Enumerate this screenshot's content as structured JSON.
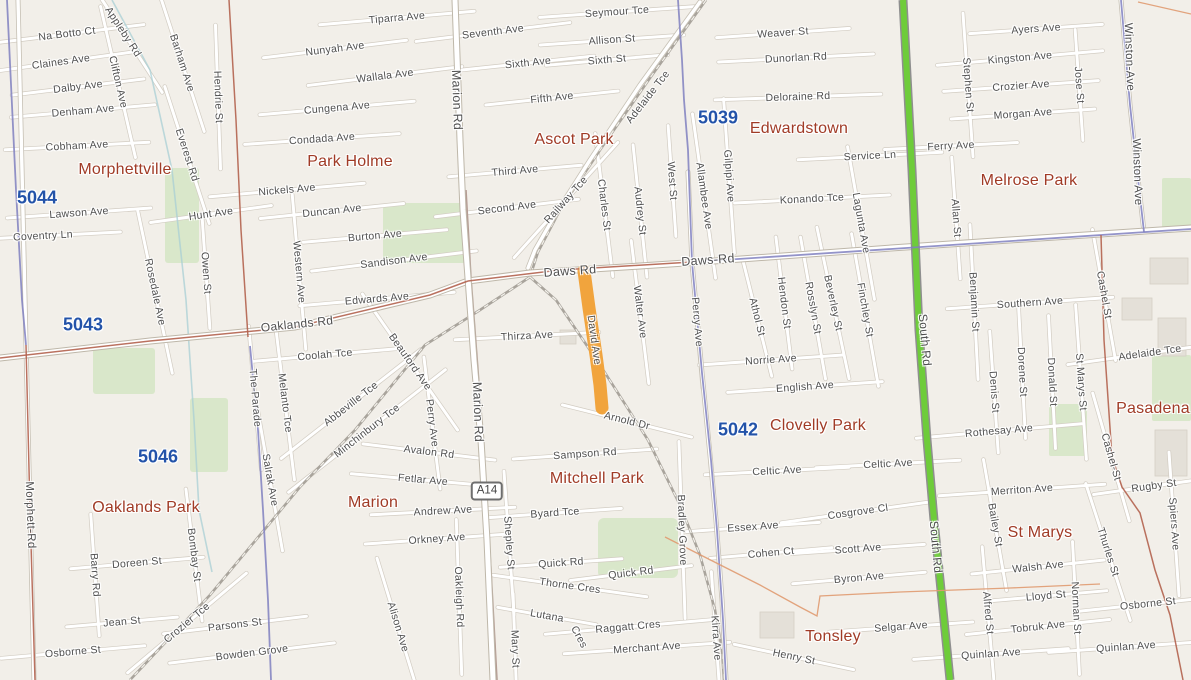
{
  "map": {
    "background": "#f2efe9",
    "colors": {
      "highlight": "#f1a43d",
      "route_green": "#6ecc3a",
      "admin_blue": "#8080bf",
      "admin_red": "#b3624e",
      "boundary_orange": "#e09a70",
      "park": "#d9e7ca",
      "building": "#e4e0d8",
      "street_text": "#4f4f4f",
      "suburb_text": "#a03b26",
      "postcode_text": "#2353a9",
      "road_fill": "#ffffff",
      "rail": "#a9a49c"
    },
    "highlighted_road": {
      "name": "David Ave",
      "color": "#f1a43d"
    },
    "route_badges": [
      {
        "t": "A14",
        "x": 487,
        "y": 491
      }
    ],
    "postcodes": [
      {
        "t": "5044",
        "x": 37,
        "y": 198
      },
      {
        "t": "5043",
        "x": 83,
        "y": 325
      },
      {
        "t": "5046",
        "x": 158,
        "y": 457
      },
      {
        "t": "5039",
        "x": 718,
        "y": 118
      },
      {
        "t": "5042",
        "x": 738,
        "y": 430
      }
    ],
    "suburbs": [
      {
        "t": "Morphettville",
        "x": 125,
        "y": 170
      },
      {
        "t": "Park Holme",
        "x": 350,
        "y": 162
      },
      {
        "t": "Ascot Park",
        "x": 574,
        "y": 140
      },
      {
        "t": "Edwardstown",
        "x": 799,
        "y": 129
      },
      {
        "t": "Melrose Park",
        "x": 1029,
        "y": 181
      },
      {
        "t": "Oaklands Park",
        "x": 146,
        "y": 508
      },
      {
        "t": "Marion",
        "x": 373,
        "y": 503
      },
      {
        "t": "Mitchell Park",
        "x": 597,
        "y": 479
      },
      {
        "t": "Clovelly Park",
        "x": 818,
        "y": 426
      },
      {
        "t": "St Marys",
        "x": 1040,
        "y": 533
      },
      {
        "t": "Tonsley",
        "x": 833,
        "y": 637
      },
      {
        "t": "Pasadena",
        "x": 1153,
        "y": 409
      }
    ],
    "streets": [
      {
        "t": "Appleby Rd",
        "x": 123,
        "y": 32,
        "r": 57
      },
      {
        "t": "Na Botto Ct",
        "x": 67,
        "y": 34,
        "r": -7
      },
      {
        "t": "Claines Ave",
        "x": 61,
        "y": 62,
        "r": -8
      },
      {
        "t": "Clifton Ave",
        "x": 118,
        "y": 82,
        "r": 77
      },
      {
        "t": "Barham Ave",
        "x": 182,
        "y": 63,
        "r": 72
      },
      {
        "t": "Dalby Ave",
        "x": 78,
        "y": 87,
        "r": -7
      },
      {
        "t": "Hendrie St",
        "x": 218,
        "y": 97,
        "r": 88
      },
      {
        "t": "Denham Ave",
        "x": 83,
        "y": 111,
        "r": -5
      },
      {
        "t": "Everest Rd",
        "x": 187,
        "y": 155,
        "r": 72
      },
      {
        "t": "Cobham Ave",
        "x": 77,
        "y": 146,
        "r": -3
      },
      {
        "t": "Hunt Ave",
        "x": 211,
        "y": 214,
        "r": -8
      },
      {
        "t": "Lawson Ave",
        "x": 79,
        "y": 213,
        "r": -4
      },
      {
        "t": "Coventry Ln",
        "x": 43,
        "y": 236,
        "r": -3
      },
      {
        "t": "Nickels Ave",
        "x": 287,
        "y": 190,
        "r": -5
      },
      {
        "t": "Duncan Ave",
        "x": 332,
        "y": 211,
        "r": -6
      },
      {
        "t": "Owen St",
        "x": 206,
        "y": 273,
        "r": 86
      },
      {
        "t": "Rosedale Ave",
        "x": 155,
        "y": 292,
        "r": 78
      },
      {
        "t": "Western Ave",
        "x": 299,
        "y": 272,
        "r": 85
      },
      {
        "t": "Burton Ave",
        "x": 375,
        "y": 236,
        "r": -5
      },
      {
        "t": "Sandison Ave",
        "x": 394,
        "y": 261,
        "r": -7
      },
      {
        "t": "Edwards Ave",
        "x": 377,
        "y": 299,
        "r": -5
      },
      {
        "t": "Oaklands Rd",
        "x": 297,
        "y": 324,
        "r": -6,
        "s": 12,
        "nr": true
      },
      {
        "t": "The-Parade",
        "x": 255,
        "y": 398,
        "r": 85
      },
      {
        "t": "Melanto Tce",
        "x": 285,
        "y": 403,
        "r": 83
      },
      {
        "t": "Salrak Ave",
        "x": 270,
        "y": 480,
        "r": 80
      },
      {
        "t": "Morphett-Rd",
        "x": 30,
        "y": 515,
        "r": 88,
        "s": 11.5,
        "nr": true
      },
      {
        "t": "Tiparra Ave",
        "x": 397,
        "y": 18,
        "r": -5
      },
      {
        "t": "Nunyah Ave",
        "x": 335,
        "y": 49,
        "r": -7
      },
      {
        "t": "Wallala Ave",
        "x": 385,
        "y": 76,
        "r": -7
      },
      {
        "t": "Cungena Ave",
        "x": 337,
        "y": 108,
        "r": -5
      },
      {
        "t": "Condada Ave",
        "x": 322,
        "y": 139,
        "r": -4
      },
      {
        "t": "Marion Rd",
        "x": 457,
        "y": 100,
        "r": 88,
        "s": 12.5,
        "nr": true
      },
      {
        "t": "Marion Rd",
        "x": 478,
        "y": 412,
        "r": 88,
        "s": 12.5,
        "nr": true
      },
      {
        "t": "Seventh Ave",
        "x": 493,
        "y": 32,
        "r": -7
      },
      {
        "t": "Sixth Ave",
        "x": 528,
        "y": 63,
        "r": -6
      },
      {
        "t": "Sixth St",
        "x": 607,
        "y": 60,
        "r": -5
      },
      {
        "t": "Fifth Ave",
        "x": 552,
        "y": 98,
        "r": -6
      },
      {
        "t": "Third Ave",
        "x": 515,
        "y": 171,
        "r": -5
      },
      {
        "t": "Second Ave",
        "x": 507,
        "y": 208,
        "r": -7
      },
      {
        "t": "Railway Tce",
        "x": 566,
        "y": 200,
        "r": -48
      },
      {
        "t": "Charles St",
        "x": 604,
        "y": 205,
        "r": 83
      },
      {
        "t": "Audrey St",
        "x": 640,
        "y": 211,
        "r": 84
      },
      {
        "t": "Seymour Tce",
        "x": 617,
        "y": 12,
        "r": -4
      },
      {
        "t": "Allison St",
        "x": 612,
        "y": 40,
        "r": -4
      },
      {
        "t": "Adelaide Tce",
        "x": 648,
        "y": 97,
        "r": -52,
        "nr": true
      },
      {
        "t": "West St",
        "x": 672,
        "y": 181,
        "r": 86
      },
      {
        "t": "Allambee Ave",
        "x": 704,
        "y": 196,
        "r": 82
      },
      {
        "t": "Gilpipi Ave",
        "x": 729,
        "y": 176,
        "r": 86
      },
      {
        "t": "Weaver St",
        "x": 783,
        "y": 33,
        "r": -4
      },
      {
        "t": "Dunorlan Rd",
        "x": 796,
        "y": 58,
        "r": -3
      },
      {
        "t": "Deloraine Rd",
        "x": 798,
        "y": 97,
        "r": -2
      },
      {
        "t": "Konando Tce",
        "x": 812,
        "y": 199,
        "r": -3
      },
      {
        "t": "Service Ln",
        "x": 870,
        "y": 156,
        "r": -3
      },
      {
        "t": "Ferry Ave",
        "x": 951,
        "y": 146,
        "r": -3
      },
      {
        "t": "Lagunta Ave",
        "x": 861,
        "y": 223,
        "r": 80
      },
      {
        "t": "Ayers Ave",
        "x": 1036,
        "y": 29,
        "r": -4
      },
      {
        "t": "Kingston Ave",
        "x": 1020,
        "y": 58,
        "r": -5
      },
      {
        "t": "Stephen St",
        "x": 968,
        "y": 85,
        "r": 86
      },
      {
        "t": "Crozier Ave",
        "x": 1021,
        "y": 86,
        "r": -4
      },
      {
        "t": "Jose St",
        "x": 1079,
        "y": 85,
        "r": 86
      },
      {
        "t": "Morgan Ave",
        "x": 1023,
        "y": 114,
        "r": -4
      },
      {
        "t": "Winston-Ave",
        "x": 1129,
        "y": 57,
        "r": 88,
        "s": 11.5,
        "nr": true
      },
      {
        "t": "Winston Ave",
        "x": 1137,
        "y": 172,
        "r": 88,
        "s": 11.5,
        "nr": true
      },
      {
        "t": "Daws Rd",
        "x": 570,
        "y": 271,
        "r": -4,
        "s": 12.5,
        "nr": true
      },
      {
        "t": "Daws-Rd",
        "x": 708,
        "y": 260,
        "r": -4,
        "s": 12.5,
        "nr": true
      },
      {
        "t": "Walter Ave",
        "x": 640,
        "y": 312,
        "r": 83
      },
      {
        "t": "Percy Ave",
        "x": 697,
        "y": 322,
        "r": 85
      },
      {
        "t": "Athol St",
        "x": 757,
        "y": 317,
        "r": 76
      },
      {
        "t": "Hendon St",
        "x": 784,
        "y": 303,
        "r": 83
      },
      {
        "t": "Rosslyn St",
        "x": 813,
        "y": 308,
        "r": 80
      },
      {
        "t": "Beverley St",
        "x": 833,
        "y": 303,
        "r": 78
      },
      {
        "t": "Finchley St",
        "x": 865,
        "y": 310,
        "r": 80
      },
      {
        "t": "Norrie Ave",
        "x": 771,
        "y": 360,
        "r": -4
      },
      {
        "t": "English Ave",
        "x": 805,
        "y": 387,
        "r": -4
      },
      {
        "t": "Allan St",
        "x": 956,
        "y": 218,
        "r": 86
      },
      {
        "t": "Benjamin St",
        "x": 974,
        "y": 302,
        "r": 87
      },
      {
        "t": "Southern Ave",
        "x": 1030,
        "y": 303,
        "r": -4
      },
      {
        "t": "Cashel St",
        "x": 1104,
        "y": 295,
        "r": 80
      },
      {
        "t": "Adelaide Tce",
        "x": 1150,
        "y": 353,
        "r": -8
      },
      {
        "t": "St Marys St",
        "x": 1081,
        "y": 382,
        "r": 86
      },
      {
        "t": "Donald St",
        "x": 1052,
        "y": 382,
        "r": 87
      },
      {
        "t": "Dorene St",
        "x": 1022,
        "y": 372,
        "r": 87
      },
      {
        "t": "Denis St",
        "x": 994,
        "y": 392,
        "r": 86
      },
      {
        "t": "Rothesay Ave",
        "x": 999,
        "y": 431,
        "r": -5
      },
      {
        "t": "Cashel-St",
        "x": 1111,
        "y": 457,
        "r": 74
      },
      {
        "t": "Thirza Ave",
        "x": 527,
        "y": 336,
        "r": -3
      },
      {
        "t": "Coolah Tce",
        "x": 325,
        "y": 355,
        "r": -5
      },
      {
        "t": "Abbeville Tce",
        "x": 351,
        "y": 404,
        "r": -38
      },
      {
        "t": "Minchinbury Tce",
        "x": 367,
        "y": 431,
        "r": -38
      },
      {
        "t": "Beauford Ave",
        "x": 410,
        "y": 362,
        "r": 55
      },
      {
        "t": "Perry Ave",
        "x": 432,
        "y": 423,
        "r": 83
      },
      {
        "t": "Avalon Rd",
        "x": 429,
        "y": 452,
        "r": 7
      },
      {
        "t": "Fetlar Ave",
        "x": 423,
        "y": 480,
        "r": 5
      },
      {
        "t": "Andrew Ave",
        "x": 443,
        "y": 511,
        "r": -3
      },
      {
        "t": "Orkney Ave",
        "x": 437,
        "y": 539,
        "r": -4
      },
      {
        "t": "Alison Ave",
        "x": 398,
        "y": 627,
        "r": 73
      },
      {
        "t": "Oakleigh Rd",
        "x": 459,
        "y": 597,
        "r": 88
      },
      {
        "t": "Shepley St",
        "x": 509,
        "y": 543,
        "r": 86
      },
      {
        "t": "Mary St",
        "x": 515,
        "y": 649,
        "r": 88
      },
      {
        "t": "Byard Tce",
        "x": 555,
        "y": 513,
        "r": -4
      },
      {
        "t": "Quick Rd",
        "x": 561,
        "y": 563,
        "r": -4
      },
      {
        "t": "Quick Rd",
        "x": 631,
        "y": 573,
        "r": -7
      },
      {
        "t": "Thorne Cres",
        "x": 570,
        "y": 586,
        "r": 8
      },
      {
        "t": "Lutana",
        "x": 547,
        "y": 616,
        "r": 10
      },
      {
        "t": "Cres",
        "x": 579,
        "y": 637,
        "r": 62,
        "nr": true
      },
      {
        "t": "Raggatt Cres",
        "x": 628,
        "y": 627,
        "r": -5
      },
      {
        "t": "Merchant Ave",
        "x": 647,
        "y": 648,
        "r": -4
      },
      {
        "t": "Sampson Rd",
        "x": 585,
        "y": 454,
        "r": -4
      },
      {
        "t": "Arnold Dr",
        "x": 627,
        "y": 421,
        "r": 14
      },
      {
        "t": "David Ave",
        "x": 594,
        "y": 340,
        "r": 82,
        "nr": true
      },
      {
        "t": "Bradley Grove",
        "x": 682,
        "y": 530,
        "r": 88
      },
      {
        "t": "Kirra Ave",
        "x": 716,
        "y": 638,
        "r": 86
      },
      {
        "t": "Celtic Ave",
        "x": 777,
        "y": 471,
        "r": -3
      },
      {
        "t": "Celtic Ave",
        "x": 888,
        "y": 464,
        "r": -3
      },
      {
        "t": "Essex Ave",
        "x": 753,
        "y": 527,
        "r": -4
      },
      {
        "t": "Cohen Ct",
        "x": 771,
        "y": 553,
        "r": -5
      },
      {
        "t": "Cosgrove Cl",
        "x": 858,
        "y": 512,
        "r": -8
      },
      {
        "t": "Scott Ave",
        "x": 858,
        "y": 549,
        "r": -4
      },
      {
        "t": "Byron Ave",
        "x": 859,
        "y": 578,
        "r": -5
      },
      {
        "t": "Henry St",
        "x": 794,
        "y": 657,
        "r": 12
      },
      {
        "t": "Selgar Ave",
        "x": 901,
        "y": 627,
        "r": -4
      },
      {
        "t": "Merriton Ave",
        "x": 1022,
        "y": 490,
        "r": -4
      },
      {
        "t": "Bailey St",
        "x": 995,
        "y": 525,
        "r": 80
      },
      {
        "t": "Rugby St",
        "x": 1154,
        "y": 486,
        "r": -8
      },
      {
        "t": "Spiers Ave",
        "x": 1174,
        "y": 524,
        "r": 86
      },
      {
        "t": "South Rd",
        "x": 925,
        "y": 340,
        "r": 85,
        "s": 12,
        "nr": true
      },
      {
        "t": "South Rd",
        "x": 936,
        "y": 547,
        "r": 85,
        "s": 12,
        "nr": true
      },
      {
        "t": "Walsh Ave",
        "x": 1038,
        "y": 567,
        "r": -6
      },
      {
        "t": "Thurles St",
        "x": 1108,
        "y": 552,
        "r": 72
      },
      {
        "t": "Lloyd St",
        "x": 1046,
        "y": 596,
        "r": -5
      },
      {
        "t": "Norman St",
        "x": 1076,
        "y": 608,
        "r": 87
      },
      {
        "t": "Osborne St",
        "x": 1148,
        "y": 604,
        "r": -6
      },
      {
        "t": "Alfred St",
        "x": 988,
        "y": 613,
        "r": 85
      },
      {
        "t": "Tobruk Ave",
        "x": 1038,
        "y": 627,
        "r": -6
      },
      {
        "t": "Quinlan Ave",
        "x": 991,
        "y": 654,
        "r": -4
      },
      {
        "t": "Quinlan Ave",
        "x": 1126,
        "y": 647,
        "r": -4
      },
      {
        "t": "Barry Rd",
        "x": 95,
        "y": 575,
        "r": 86
      },
      {
        "t": "Doreen St",
        "x": 137,
        "y": 563,
        "r": -5
      },
      {
        "t": "Bombay St",
        "x": 194,
        "y": 555,
        "r": 83
      },
      {
        "t": "Jean St",
        "x": 122,
        "y": 622,
        "r": -5
      },
      {
        "t": "Crozier Tce",
        "x": 187,
        "y": 623,
        "r": -40
      },
      {
        "t": "Parsons St",
        "x": 235,
        "y": 625,
        "r": -7
      },
      {
        "t": "Osborne St",
        "x": 73,
        "y": 652,
        "r": -5
      },
      {
        "t": "Bowden Grove",
        "x": 252,
        "y": 653,
        "r": -7
      }
    ]
  }
}
